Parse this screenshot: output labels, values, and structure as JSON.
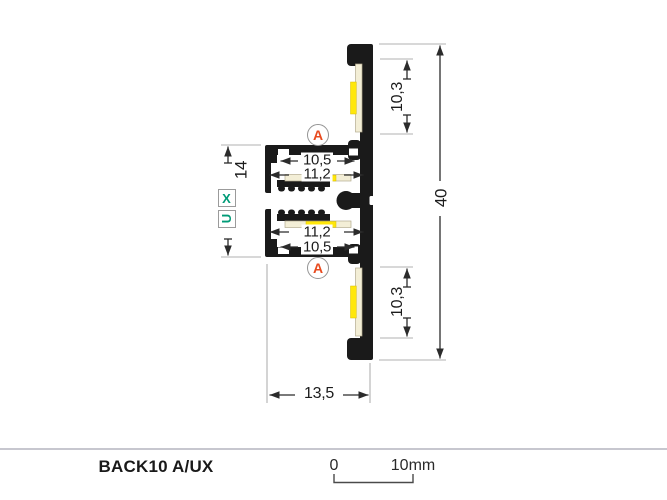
{
  "drawing": {
    "type": "led-profile-cross-section",
    "dimensions": {
      "overall_height": "40",
      "led_zone_top": "10,3",
      "led_zone_bottom": "10,3",
      "slot_height": "14",
      "upper_channel_inner_width": "10,5",
      "upper_channel_outer_width": "11,2",
      "lower_channel_outer_width": "11,2",
      "lower_channel_inner_width": "10,5",
      "overall_width": "13,5"
    },
    "markers": {
      "section": "A",
      "slot_x": "X",
      "slot_u": "U"
    },
    "colors": {
      "profile_black": "#1a1a1a",
      "section_marker_red": "#e84a1e",
      "slot_marker_green": "#009b77",
      "led_yellow": "#ffe70a",
      "pcb_cream": "#f3eed6",
      "extension_line_gray": "#b0b0b0",
      "dimension_line_dark": "#2b2b2b"
    }
  },
  "footer": {
    "product_name": "BACK10 A/UX",
    "scale_zero": "0",
    "scale_max": "10mm"
  }
}
